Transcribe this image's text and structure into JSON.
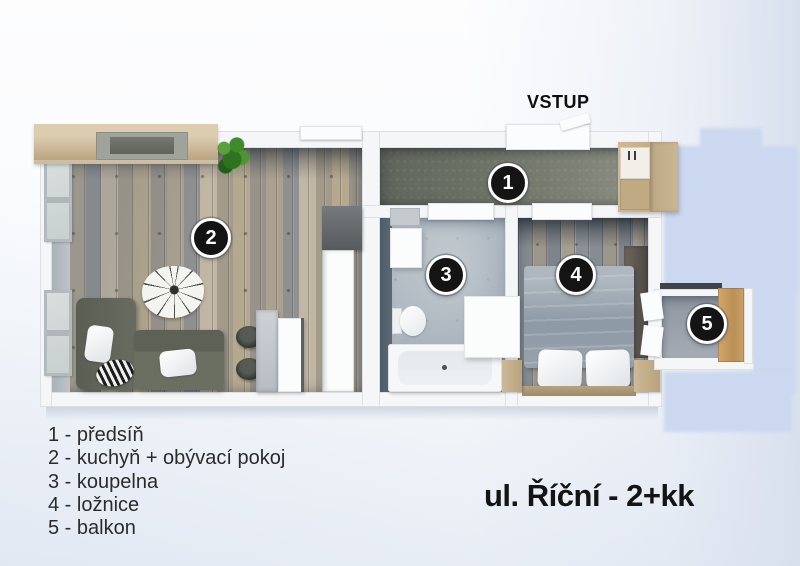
{
  "title": "ul. Říční - 2+kk",
  "entrance_label": "VSTUP",
  "rooms": [
    {
      "number": "1",
      "name": "předsíň",
      "legend_text": "1 - předsíň"
    },
    {
      "number": "2",
      "name": "kuchyň + obývací pokoj",
      "legend_text": "2 - kuchyň + obývací pokoj"
    },
    {
      "number": "3",
      "name": "koupelna",
      "legend_text": "3 - koupelna"
    },
    {
      "number": "4",
      "name": "ložnice",
      "legend_text": "4 - ložnice"
    },
    {
      "number": "5",
      "name": "balkon",
      "legend_text": "5 - balkon"
    }
  ],
  "palette": {
    "background_tint": "#d8e0ee",
    "cast_shadow": "#cbd8ef",
    "wall_white": "#f5f6f7",
    "hall_carpet": "#6e7367",
    "wood_floor_tan": "#b4a88f",
    "wood_floor_gray": "#8f9090",
    "bath_floor": "#a9b3bc",
    "wood_furniture": "#c0ab85",
    "sofa_gray": "#63675c",
    "marker_background": "#141414",
    "marker_text": "#ffffff",
    "text_color": "#2b2b2b"
  }
}
